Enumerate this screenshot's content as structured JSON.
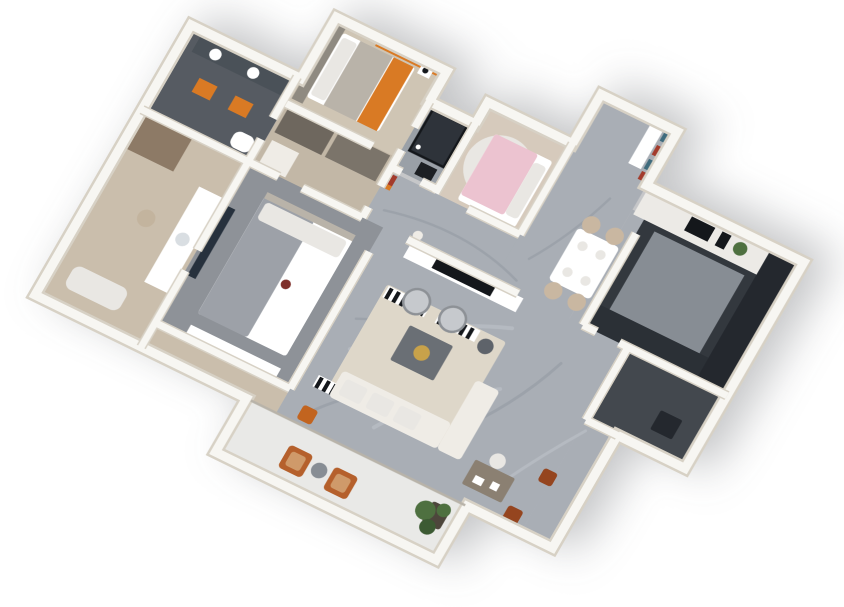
{
  "scene": {
    "kind": "3d-isometric-floor-plan-render",
    "background": "#ffffff"
  },
  "palette": {
    "wall": "#f7f6f2",
    "wall_edge": "#d7d1c5",
    "glass": "#b8b3a9",
    "marble": "#a9aeb5",
    "marble_vein": "#848b94",
    "marble_light": "#ccd0d5",
    "wood": "#cabeac",
    "wood2": "#cfc5b4",
    "wood_closet": "#c2b7a6",
    "wood_dark": "#8d7a66",
    "carpet": "#8e9298",
    "blanket_gray": "#9da1a8",
    "bath_dark": "#565b62",
    "bath_counter": "#4a5158",
    "mirror": "#dfe5e9",
    "tile": "#9aa0a7",
    "pink_floor": "#d6cabc",
    "pink": "#ecc3d0",
    "pink_curtain": "#f0c9d6",
    "orange": "#d97a24",
    "orange_deep": "#c2641f",
    "blue_gray": "#5e7486",
    "teal": "#3f6b7d",
    "red_art": "#a33b2c",
    "kitchen_dark": "#24282e",
    "kitchen_dark2": "#2b3036",
    "kitchen_mid": "#33383e",
    "kitchen_floor": "#878d94",
    "counter_white": "#eceae6",
    "passage": "#43484e",
    "balcony": "#e9e9e7",
    "white": "#ffffff",
    "cream": "#efece6",
    "soft_white": "#e9e7e3",
    "rug": "#ded7c9",
    "table_gray": "#6a6f75",
    "gold": "#c8a24a",
    "leather": "#95451f",
    "chair_tan": "#c9b7a1",
    "gray_chair": "#c6c9cd",
    "gray_chair_edge": "#8d9196",
    "plant": "#4e7040",
    "plant_dark": "#3c5a33",
    "planter": "#4d463c",
    "tv": "#14171b",
    "navy": "#27313d",
    "sink": "#d9dee2",
    "red_dot": "#7e2f2a",
    "headboard": "#b9b3a9",
    "wardrobe_gray": "#8f8a81",
    "closet_dark": "#6e675e",
    "closet_dark2": "#7b746a",
    "pouf": "#c3b49e",
    "desk": "#8b8072",
    "side_table": "#5e636a",
    "chair_orange": "#b5602c",
    "chair_cushion": "#cf9a6a",
    "shower_box": "#2e333a",
    "rack_black": "#1c1f23"
  },
  "rooms": [
    {
      "id": "master-bathroom",
      "floor": "wood"
    },
    {
      "id": "bathroom",
      "floor": "bath_dark"
    },
    {
      "id": "walk-in-closet",
      "floor": "wood_closet"
    },
    {
      "id": "master-bedroom",
      "floor": "carpet"
    },
    {
      "id": "second-bedroom",
      "floor": "wood2"
    },
    {
      "id": "shower-room",
      "floor": "tile"
    },
    {
      "id": "kids-bedroom",
      "floor": "pink_floor"
    },
    {
      "id": "hallway",
      "floor": "marble"
    },
    {
      "id": "entry-dining",
      "floor": "marble"
    },
    {
      "id": "kitchen",
      "floor": "kitchen_mid"
    },
    {
      "id": "utility-passage",
      "floor": "passage"
    },
    {
      "id": "living-room",
      "floor": "marble"
    },
    {
      "id": "balcony",
      "floor": "balcony"
    }
  ]
}
